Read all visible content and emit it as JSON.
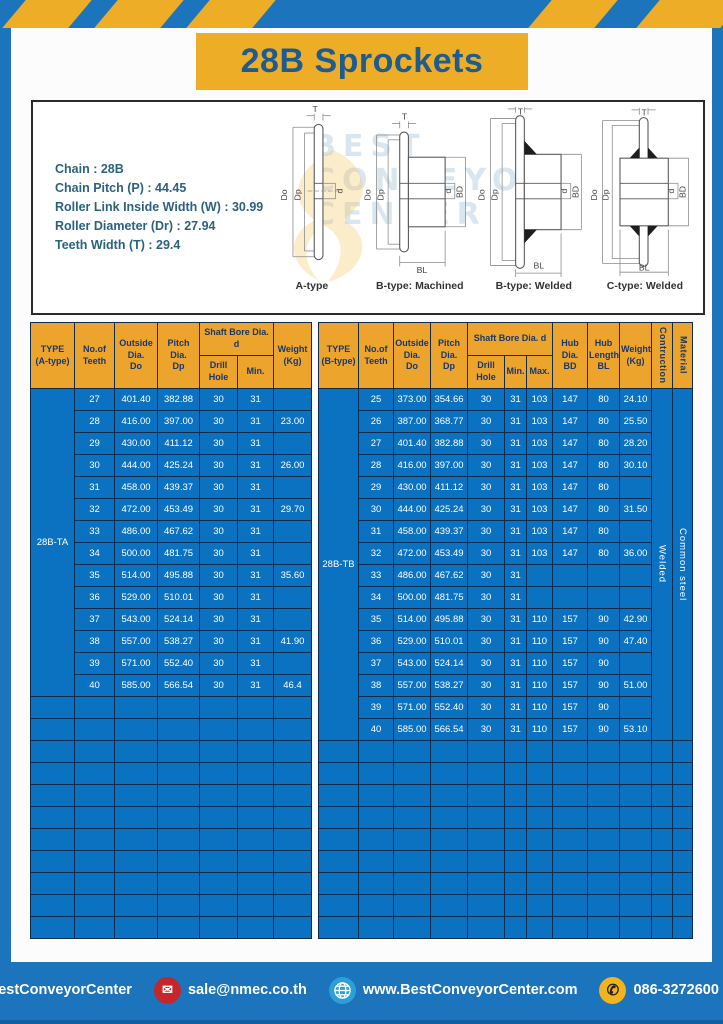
{
  "page_title": "28B Sprockets",
  "specs": {
    "lines": [
      "Chain  : 28B",
      "Chain Pitch (P)  : 44.45",
      "Roller Link Inside Width (W)  : 30.99",
      "Roller Diameter (Dr)  : 27.94",
      "Teeth Width (T)  : 29.4"
    ]
  },
  "watermark": {
    "lines": [
      "BEST",
      "CONVEYOR",
      "CENTER"
    ]
  },
  "dims": {
    "T": "T",
    "Do": "Do",
    "Dp": "Dp",
    "d": "d",
    "BD": "BD",
    "BL": "BL"
  },
  "diagrams": {
    "labels": [
      "A-type",
      "B-type: Machined",
      "B-type: Welded",
      "C-type: Welded"
    ]
  },
  "table_a": {
    "headers": {
      "type": "TYPE\n(A-type)",
      "teeth": "No.of\nTeeth",
      "outside": "Outside\nDia.\nDo",
      "pitch": "Pitch Dia.\nDp",
      "shaft_bore": "Shaft Bore Dia. d",
      "drill": "Drill Hole",
      "min": "Min.",
      "weight": "Weight\n(Kg)"
    },
    "type_label": "28B-TA",
    "rows": [
      [
        "27",
        "401.40",
        "382.88",
        "30",
        "31",
        ""
      ],
      [
        "28",
        "416.00",
        "397.00",
        "30",
        "31",
        "23.00"
      ],
      [
        "29",
        "430.00",
        "411.12",
        "30",
        "31",
        ""
      ],
      [
        "30",
        "444.00",
        "425.24",
        "30",
        "31",
        "26.00"
      ],
      [
        "31",
        "458.00",
        "439.37",
        "30",
        "31",
        ""
      ],
      [
        "32",
        "472.00",
        "453.49",
        "30",
        "31",
        "29.70"
      ],
      [
        "33",
        "486.00",
        "467.62",
        "30",
        "31",
        ""
      ],
      [
        "34",
        "500.00",
        "481.75",
        "30",
        "31",
        ""
      ],
      [
        "35",
        "514.00",
        "495.88",
        "30",
        "31",
        "35.60"
      ],
      [
        "36",
        "529.00",
        "510.01",
        "30",
        "31",
        ""
      ],
      [
        "37",
        "543.00",
        "524.14",
        "30",
        "31",
        ""
      ],
      [
        "38",
        "557.00",
        "538.27",
        "30",
        "31",
        "41.90"
      ],
      [
        "39",
        "571.00",
        "552.40",
        "30",
        "31",
        ""
      ],
      [
        "40",
        "585.00",
        "566.54",
        "30",
        "31",
        "46.4"
      ]
    ],
    "empty_rows": 11
  },
  "table_b": {
    "headers": {
      "type": "TYPE\n(B-type)",
      "teeth": "No.of\nTeeth",
      "outside": "Outside\nDia.\nDo",
      "pitch": "Pitch Dia.\nDp",
      "shaft_bore": "Shaft Bore Dia. d",
      "drill": "Drill Hole",
      "min": "Min.",
      "max": "Max.",
      "hub_dia": "Hub Dia.\nBD",
      "hub_len": "Hub\nLength\nBL",
      "weight": "Weight\n(Kg)",
      "construction": "Contruction",
      "material": "Material"
    },
    "type_label": "28B-TB",
    "construction_value": "Welded",
    "material_value": "Common steel",
    "rows": [
      [
        "25",
        "373.00",
        "354.66",
        "30",
        "31",
        "103",
        "147",
        "80",
        "24.10"
      ],
      [
        "26",
        "387.00",
        "368.77",
        "30",
        "31",
        "103",
        "147",
        "80",
        "25.50"
      ],
      [
        "27",
        "401.40",
        "382.88",
        "30",
        "31",
        "103",
        "147",
        "80",
        "28.20"
      ],
      [
        "28",
        "416.00",
        "397.00",
        "30",
        "31",
        "103",
        "147",
        "80",
        "30.10"
      ],
      [
        "29",
        "430.00",
        "411.12",
        "30",
        "31",
        "103",
        "147",
        "80",
        ""
      ],
      [
        "30",
        "444.00",
        "425.24",
        "30",
        "31",
        "103",
        "147",
        "80",
        "31.50"
      ],
      [
        "31",
        "458.00",
        "439.37",
        "30",
        "31",
        "103",
        "147",
        "80",
        ""
      ],
      [
        "32",
        "472.00",
        "453.49",
        "30",
        "31",
        "103",
        "147",
        "80",
        "36.00"
      ],
      [
        "33",
        "486.00",
        "467.62",
        "30",
        "31",
        "",
        "",
        "",
        ""
      ],
      [
        "34",
        "500.00",
        "481.75",
        "30",
        "31",
        "",
        "",
        "",
        ""
      ],
      [
        "35",
        "514.00",
        "495.88",
        "30",
        "31",
        "110",
        "157",
        "90",
        "42.90"
      ],
      [
        "36",
        "529.00",
        "510.01",
        "30",
        "31",
        "110",
        "157",
        "90",
        "47.40"
      ],
      [
        "37",
        "543.00",
        "524.14",
        "30",
        "31",
        "110",
        "157",
        "90",
        ""
      ],
      [
        "38",
        "557.00",
        "538.27",
        "30",
        "31",
        "110",
        "157",
        "90",
        "51.00"
      ],
      [
        "39",
        "571.00",
        "552.40",
        "30",
        "31",
        "110",
        "157",
        "90",
        ""
      ],
      [
        "40",
        "585.00",
        "566.54",
        "30",
        "31",
        "110",
        "157",
        "90",
        "53.10"
      ]
    ],
    "empty_rows": 9
  },
  "footer": {
    "social_handle": "@BestConveyorCenter",
    "email": "sale@nmec.co.th",
    "website": "www.BestConveyorCenter.com",
    "phone": "086-3272600 , 02-0017766",
    "line_label": "LINE",
    "facebook_letter": "f",
    "email_glyph": "✉",
    "phone_glyph": "✆"
  },
  "colors": {
    "frame_blue": "#1b74bc",
    "banner_yellow": "#eead27",
    "header_amber": "#eda42d",
    "table_blue": "#0b71c1",
    "grid_navy": "#0d2d50",
    "title_navy": "#1d5c90",
    "footer_divider_yellow": "#f3b31c"
  }
}
